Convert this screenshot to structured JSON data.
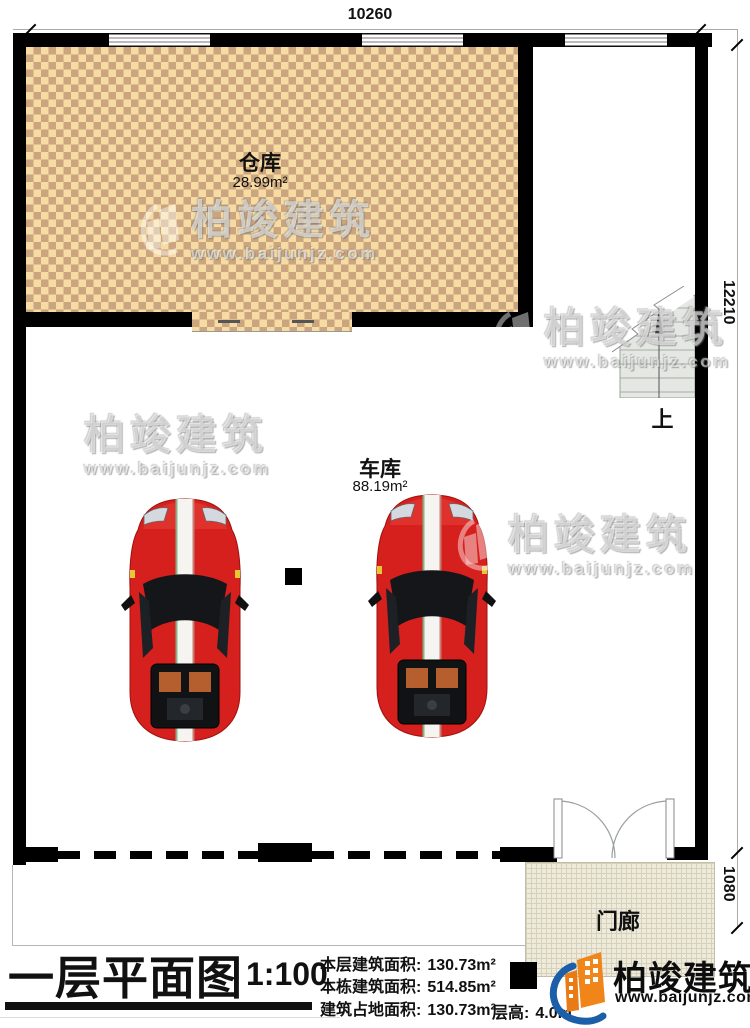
{
  "dimensions": {
    "top_width": "10260",
    "right_height": "12210",
    "porch_depth": "1080"
  },
  "rooms": {
    "storage": {
      "name": "仓库",
      "area": "28.99m²"
    },
    "garage": {
      "name": "车库",
      "area": "88.19m²"
    },
    "porch": {
      "name": "门廊"
    },
    "stair_up_label": "上"
  },
  "title_block": {
    "title": "一层平面图",
    "scale": "1:100",
    "stats": [
      {
        "label": "本层建筑面积:",
        "value": "130.73m²"
      },
      {
        "label": "本栋建筑面积:",
        "value": "514.85m²"
      },
      {
        "label": "建筑占地面积:",
        "value": "130.73m²"
      }
    ],
    "floor_height_label": "层高:",
    "floor_height_value": "4.0m"
  },
  "brand": {
    "name": "柏竣建筑",
    "url": "www.baijunjz.com"
  },
  "colors": {
    "wall": "#000000",
    "storage_floor_light": "#f6dba3",
    "storage_floor_dark": "#cba57f",
    "car_red": "#d6201e",
    "stair_gray": "#e4e7e2",
    "porch_tile": "#eeebdc",
    "logo_orange": "#f08519",
    "logo_blue": "#1b5fa8"
  }
}
